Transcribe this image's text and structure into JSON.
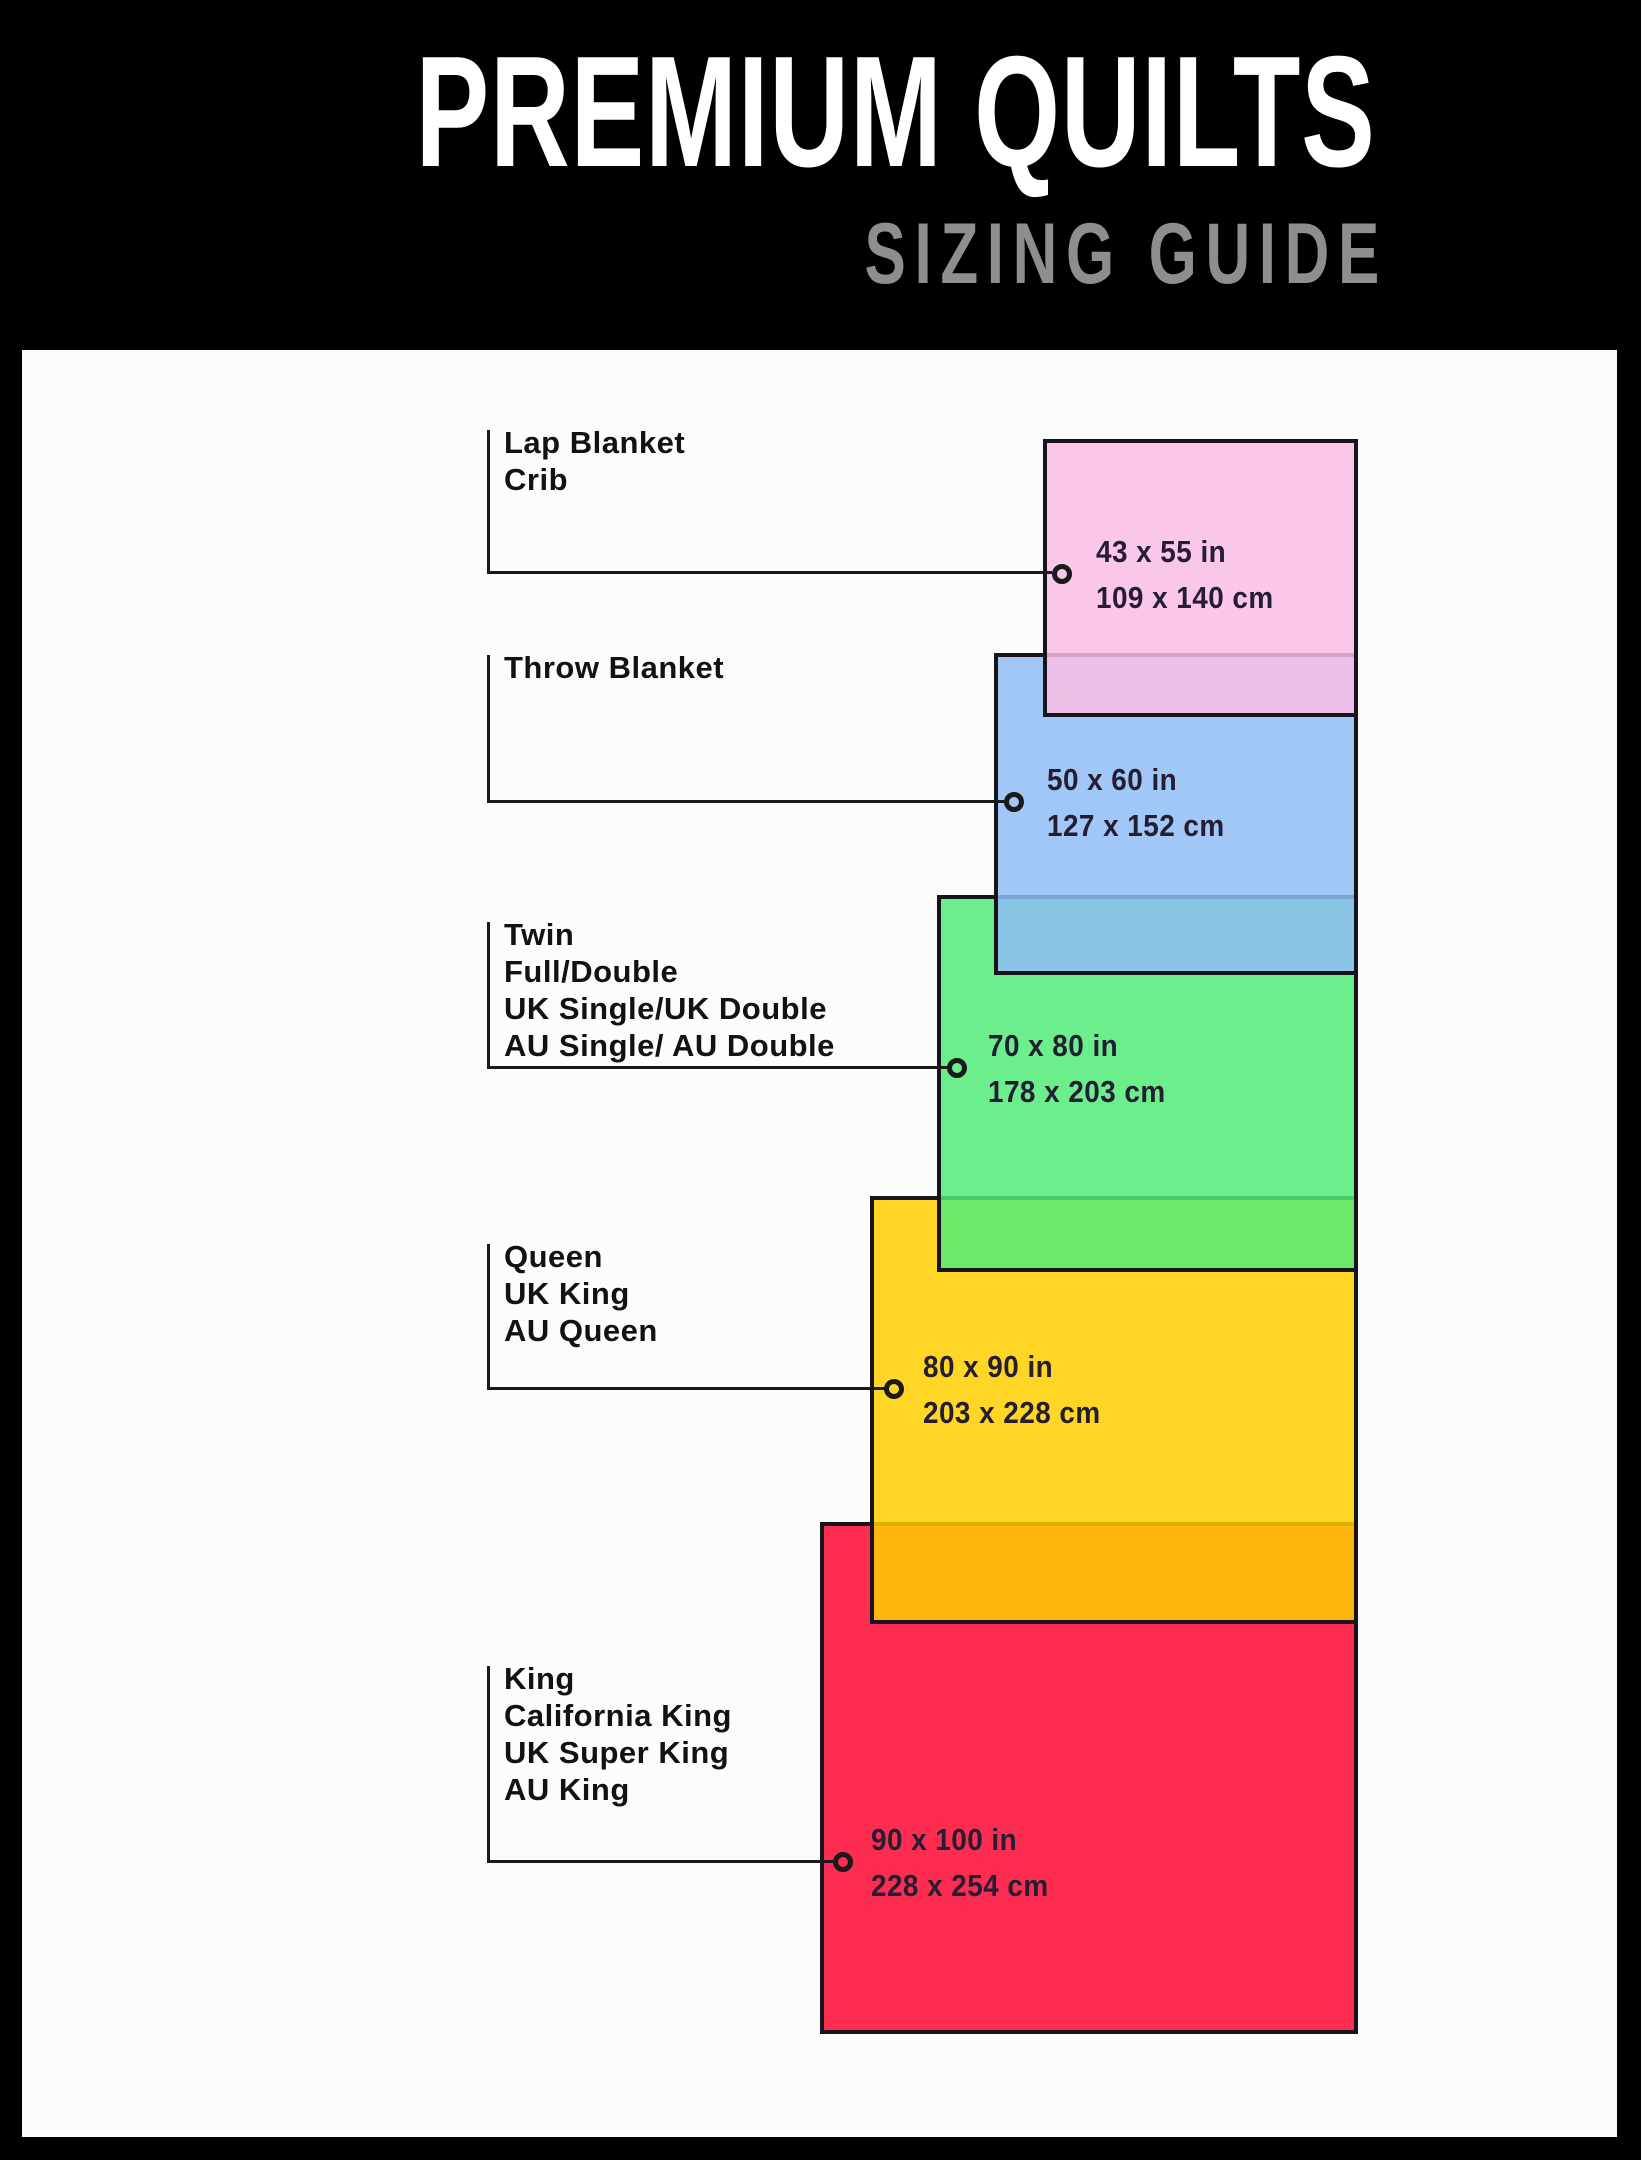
{
  "header": {
    "title": "PREMIUM QUILTS",
    "subtitle": "SIZING GUIDE"
  },
  "fill_alpha": 0.85,
  "colors": {
    "bg": "#000000",
    "panel": "#FCFCFC",
    "title": "#FFFFFF",
    "subtitle": "#8E8E8E",
    "border": "#18141D",
    "line": "#1A1A1A",
    "label": "#121212",
    "dim_text": "#241D33"
  },
  "sizes": [
    {
      "names": [
        "Lap Blanket",
        "Crib"
      ],
      "inches": "43 x 55 in",
      "cm": "109 x 140 cm",
      "fill": "#F9BDE5"
    },
    {
      "names": [
        "Throw Blanket"
      ],
      "inches": "50 x 60 in",
      "cm": "127 x 152 cm",
      "fill": "#8FBDF4"
    },
    {
      "names": [
        "Twin",
        "Full/Double",
        "UK Single/UK Double",
        "AU Single/ AU Double"
      ],
      "inches": "70 x 80 in",
      "cm": "178 x 203 cm",
      "fill": "#54EB78"
    },
    {
      "names": [
        "Queen",
        "UK King",
        "AU Queen"
      ],
      "inches": "80 x 90 in",
      "cm": "203 x 228 cm",
      "fill": "#FFCF00"
    },
    {
      "names": [
        "King",
        "California King",
        "UK Super King",
        "AU King"
      ],
      "inches": "90 x 100 in",
      "cm": "228 x 254 cm",
      "fill": "#FC0831"
    }
  ]
}
